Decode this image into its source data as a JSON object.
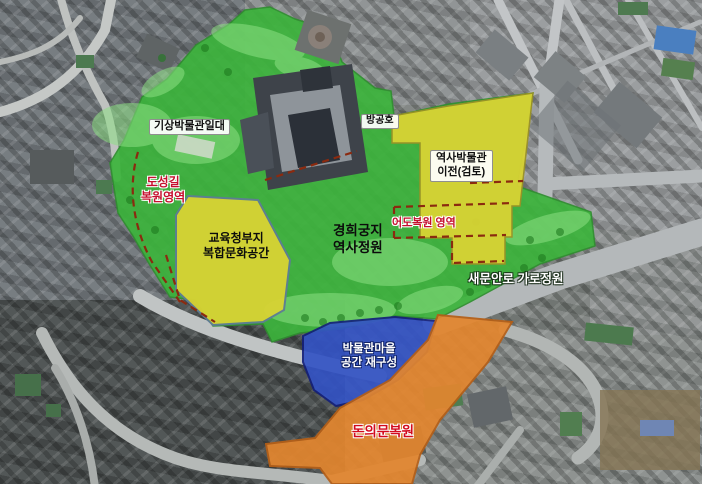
{
  "labels": {
    "weather_museum_area": "기상박물관일대",
    "air_raid_shelter": "방공호",
    "history_museum": {
      "line1": "역사박물관",
      "line2": "이전(검토)"
    },
    "doseong_trail": {
      "line1": "도성길",
      "line2": "복원영역"
    },
    "education_office": {
      "line1": "교육청부지",
      "line2": "복합문화공간"
    },
    "gyeonghuigung": {
      "line1": "경희궁지",
      "line2": "역사정원"
    },
    "eodo_restoration": "어도복원 영역",
    "saemunan_garden": "새문안로 가로정원",
    "museum_village": {
      "line1": "박물관마을",
      "line2": "공간 재구성"
    },
    "donuimun_restoration": "돈의문복원"
  },
  "zones": {
    "park_green": "#3cb43c",
    "park_green_light": "#8ce084",
    "site_yellow": "#d9d334",
    "village_blue": "#3353c4",
    "corridor_orange": "#e2862f",
    "boundary_dashed": "#8b2a0f",
    "label_red": "#c50f2d"
  }
}
